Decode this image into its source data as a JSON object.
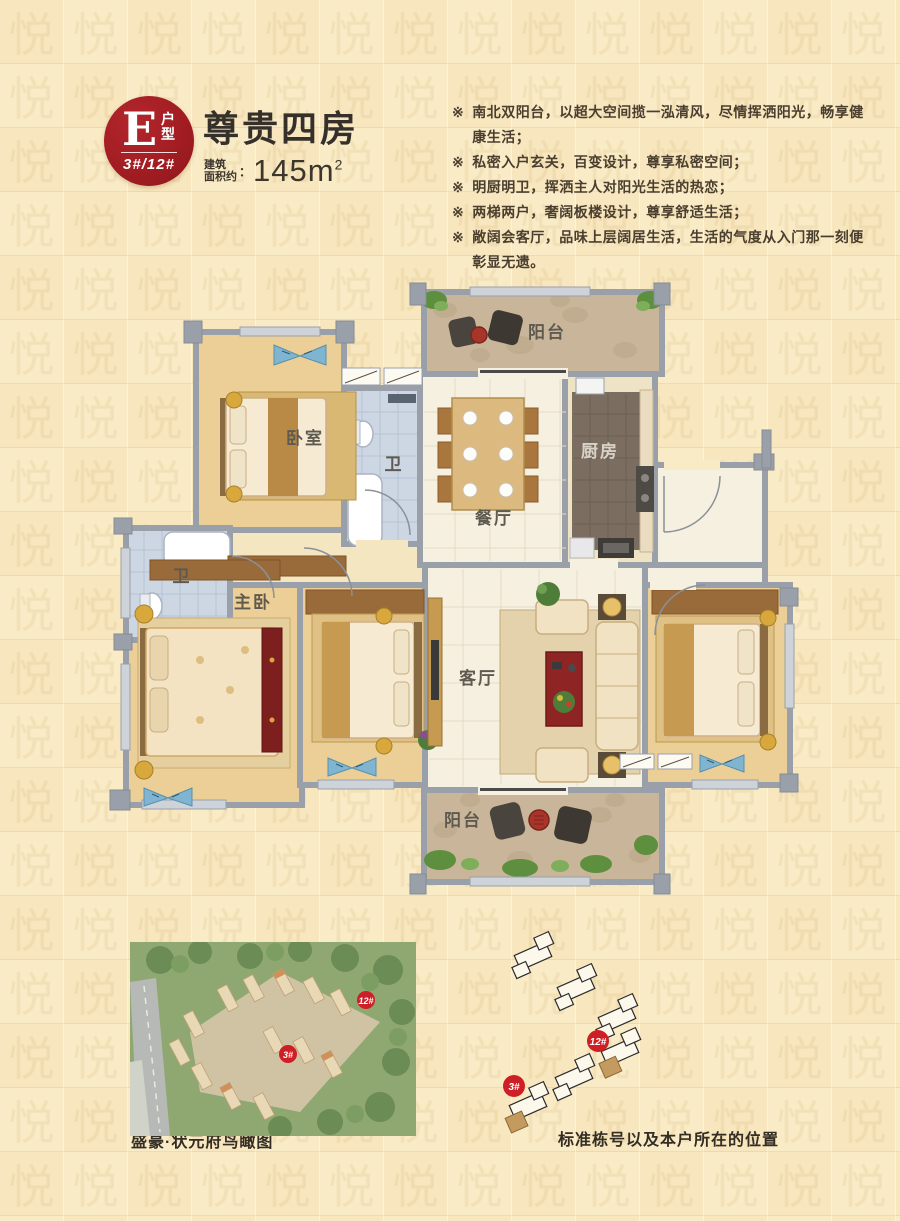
{
  "header": {
    "badge": {
      "letter": "E",
      "type_label": "户型",
      "buildings": "3#/12#"
    },
    "title": "尊贵四房",
    "area_prefix_line1": "建筑",
    "area_prefix_line2": "面积约",
    "area_colon": "：",
    "area_value": "145m",
    "area_sup": "2",
    "bullet_symbol": "※",
    "features": [
      "南北双阳台，以超大空间揽一泓清风，尽情挥洒阳光，畅享健康生活；",
      "私密入户玄关，百变设计，尊享私密空间；",
      "明厨明卫，挥洒主人对阳光生活的热恋；",
      "两梯两户，奢阔板楼设计，尊享舒适生活；",
      "敞阔会客厅，品味上层阔居生活，生活的气度从入门那一刻便彰显无遗。"
    ]
  },
  "floorplan": {
    "rooms": {
      "balcony_top": "阳台",
      "bedroom": "卧室",
      "bath_a": "卫",
      "dining": "餐厅",
      "kitchen": "厨房",
      "bath_b": "卫",
      "master": "主卧",
      "living": "客厅",
      "balcony_bottom": "阳台"
    }
  },
  "footer": {
    "aerial_caption": "盛豪·状元府鸟瞰图",
    "siteplan_caption": "标准栋号以及本户所在的位置",
    "marker_3": "3#",
    "marker_12": "12#"
  },
  "decor": {
    "watermark_char": "悦"
  },
  "palette": {
    "background": "#f9ebc6",
    "badge_red": "#a21d22",
    "marker_red": "#cf1f26",
    "wall_gray": "#9aa0a9",
    "wood_floor": "#eccf96",
    "tile_floor": "#f6f0e1",
    "bath_tile": "#ccd7e3",
    "kitchen_floor": "#7b6e60",
    "balcony_stone": "#c9b69a",
    "highlight_tan": "#c59a5f",
    "text_dark": "#3a332a"
  }
}
